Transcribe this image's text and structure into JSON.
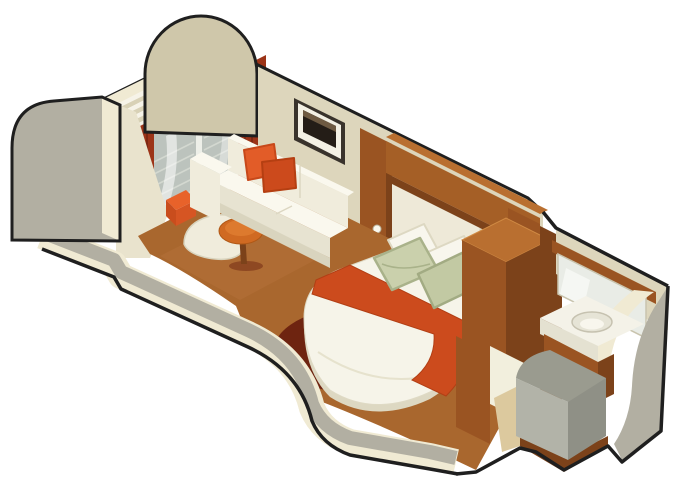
{
  "figure": {
    "kind": "isometric-cutaway-cabin-floorplan"
  },
  "palette": {
    "background": "#ffffff",
    "outline": "#1f1f1f",
    "wallCream": "#ddd6bc",
    "wallCut": "#f0ead3",
    "wallGray": "#b2afa2",
    "wallTan": "#cfc7aa",
    "wedgeCream": "#e9e3cd",
    "deckLight": "#f6f3e8",
    "deckDark": "#d8d1b6",
    "glassFrame": "#edefe8",
    "glass": "#bcc3bd",
    "glassSlat": "#d3d8d0",
    "glassStreak": "#ffffff",
    "curtain": "#9c3418",
    "curtainDark": "#7a2812",
    "carpet": "#a9672e",
    "carpetLight": "#b5713a",
    "carpetShadow": "#6e2410",
    "wood": "#a55f26",
    "woodDark": "#7c421a",
    "woodLight": "#b96f30",
    "woodMid": "#9a5422",
    "upholstery": "#f0ecdc",
    "upholsteryLight": "#faf8ee",
    "upholsteryShade": "#e7e3d1",
    "upholsteryDark": "#d9d4be",
    "pillowOrange": "#e25c28",
    "pillowOrangeDark": "#cc4a1c",
    "runner": "#cc4b1d",
    "sage": "#cad0ac",
    "sageDark": "#c2c9a3",
    "pillowWhite": "#f8f6ed",
    "mattress": "#f6f4e9",
    "mattressSide": "#ddd8c2",
    "frameDark": "#39332c",
    "photoDark": "#241d17",
    "photoLight": "#6e5a42",
    "pictureMat": "#f3f0e4",
    "headboardPanel": "#eee9d8",
    "mirror": "#e9ece6",
    "mirrorStreak": "#f7f9f5",
    "sink": "#f4f2e8",
    "sinkBowl": "#e6e4d6",
    "counterFront": "#e4e1d1",
    "showerTop": "#9a9b8f",
    "showerFront": "#b2b3a8",
    "showerSide": "#8f9086",
    "floorTan": "#dcc99e",
    "doorOpening": "#f2efdd",
    "tableOrange": "#d06a22",
    "tableOrangeLight": "#dd7a2e",
    "stoolOrange": "#e8622a",
    "stoolOrangeDark": "#c94d1d",
    "stoolOrangeSide": "#d65523"
  }
}
